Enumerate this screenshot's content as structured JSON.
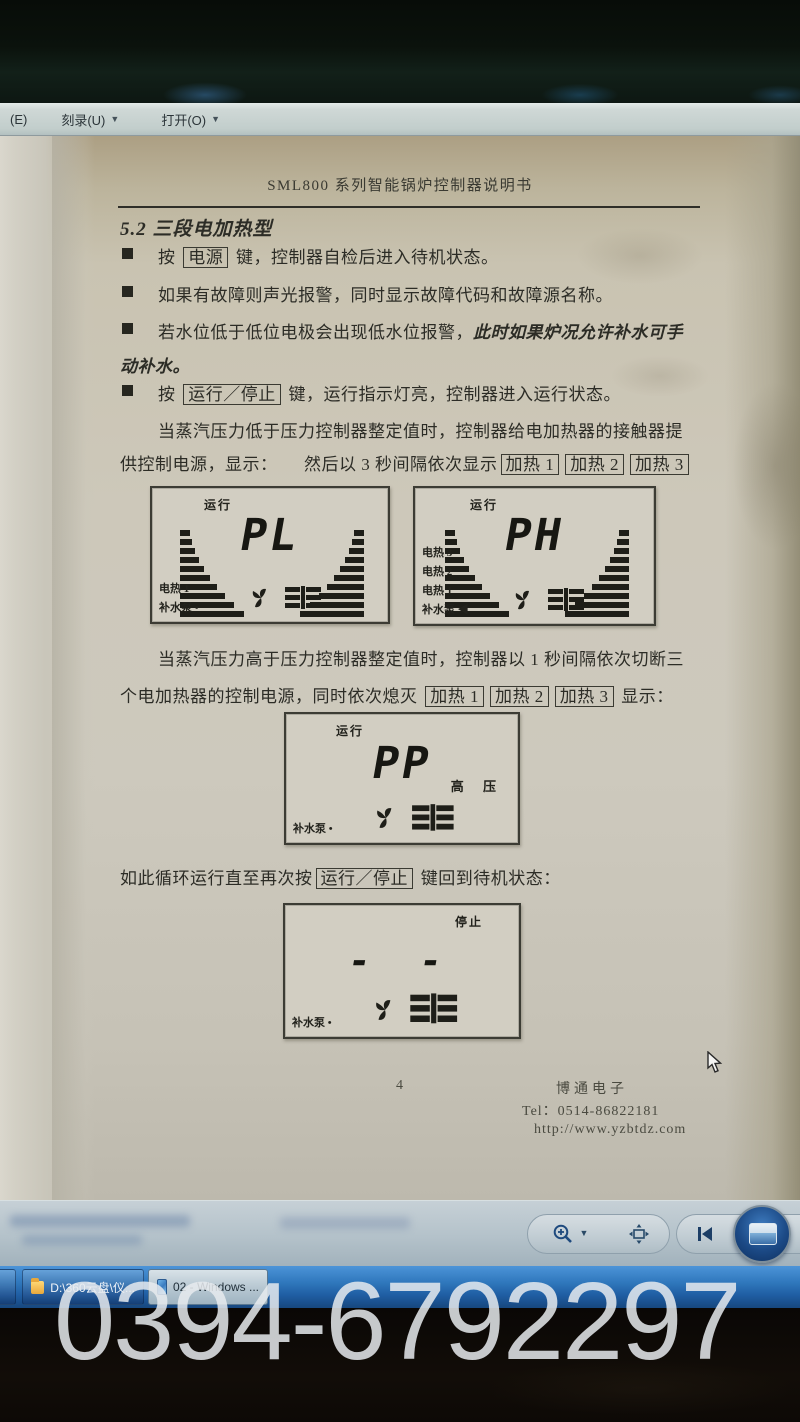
{
  "menu": {
    "partial_left": "(E)",
    "items": [
      {
        "label": "刻录(U)"
      },
      {
        "label": "打开(O)"
      }
    ]
  },
  "document": {
    "header_title": "SML800 系列智能锅炉控制器说明书",
    "section_title": "5.2 三段电加热型",
    "bullet1": [
      {
        "t": "按 "
      },
      {
        "t": "电源",
        "box": true
      },
      {
        "t": " 键，控制器自检后进入待机状态。"
      }
    ],
    "bullet2": [
      {
        "t": "如果有故障则声光报警，同时显示故障代码和故障源名称。"
      }
    ],
    "bullet3": [
      {
        "t": "若水位低于低位电极会出现低水位报警，"
      },
      {
        "t": "此时如果炉况允许补水可手",
        "i": true
      }
    ],
    "bullet3_cont": [
      {
        "t": "动补水。",
        "i": true
      }
    ],
    "bullet4": [
      {
        "t": "按 "
      },
      {
        "t": "运行／停止",
        "box": true
      },
      {
        "t": " 键，运行指示灯亮，控制器进入运行状态。"
      }
    ],
    "para1_line1": "当蒸汽压力低于压力控制器整定值时，控制器给电加热器的接触器提",
    "para1_line2": [
      {
        "t": "供控制电源，显示：　　然后以 3 秒间隔依次显示"
      },
      {
        "t": "加热 1",
        "box": true
      },
      {
        "t": "加热 2",
        "box": true
      },
      {
        "t": "加热 3",
        "box": true
      }
    ],
    "para2_line1": "当蒸汽压力高于压力控制器整定值时，控制器以 1 秒间隔依次切断三",
    "para2_line2": [
      {
        "t": "个电加热器的控制电源，同时依次熄灭 "
      },
      {
        "t": "加热 1",
        "box": true
      },
      {
        "t": "加热 2",
        "box": true
      },
      {
        "t": "加热 3",
        "box": true
      },
      {
        "t": " 显示："
      }
    ],
    "para3": [
      {
        "t": "如此循环运行直至再次按"
      },
      {
        "t": "运行／停止",
        "box": true
      },
      {
        "t": " 键回到待机状态："
      }
    ]
  },
  "lcds": [
    {
      "status": "运行",
      "value": "PL",
      "left_labels": {
        "0": "电热 1"
      },
      "pump": "补水泵 •"
    },
    {
      "status": "运行",
      "value": "PH",
      "left_labels": {
        "0": "电热 3",
        "1": "电热 2",
        "2": "电热 1"
      },
      "pump": "补水泵 ◀"
    },
    {
      "status": "运行",
      "value": "PP",
      "right_label": "高 压",
      "pump": "补水泵 •"
    },
    {
      "status": "停止",
      "value": "- -",
      "pump": "补水泵 •"
    }
  ],
  "footer": {
    "page_number": "4",
    "company": "博通电子",
    "tel": "Tel：0514-86822181",
    "url": "http://www.yzbtdz.com"
  },
  "taskbar": {
    "item1": "D:\\360云盘\\仪...",
    "item2": "02 - Windows ..."
  },
  "watermark": "0394-6792297",
  "bars_widths": [
    10,
    12,
    15,
    19,
    24,
    30,
    37,
    45,
    54,
    64
  ]
}
